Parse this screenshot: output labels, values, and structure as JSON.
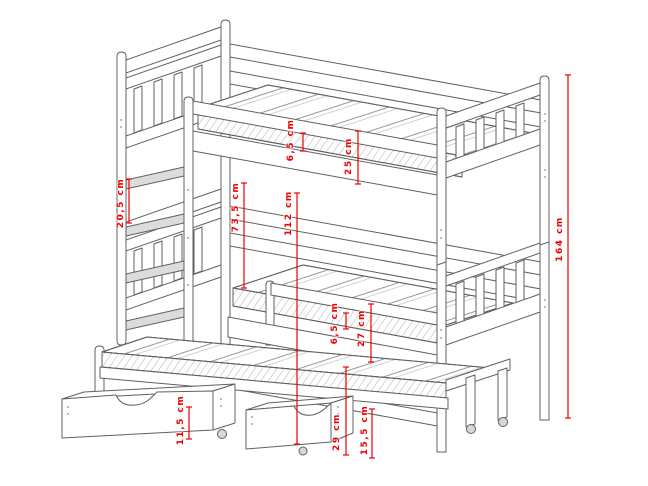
{
  "colors": {
    "dimension_red": "#f10000",
    "line_gray": "#606060",
    "background": "#ffffff"
  },
  "dimensions": [
    {
      "name": "top-mattress-thickness",
      "label": "6,5 cm"
    },
    {
      "name": "top-guardrail-height",
      "label": "25 cm"
    },
    {
      "name": "ladder-rung-spacing",
      "label": "20,5 cm"
    },
    {
      "name": "bunk-clearance-height",
      "label": "73,5 cm"
    },
    {
      "name": "top-bunk-platform-height",
      "label": "112 cm"
    },
    {
      "name": "total-bed-height",
      "label": "164 cm"
    },
    {
      "name": "bottom-mattress-thickness",
      "label": "6,5 cm"
    },
    {
      "name": "bottom-guardrail-height",
      "label": "27 cm"
    },
    {
      "name": "trundle-bed-height",
      "label": "29 cm"
    },
    {
      "name": "trundle-frame-height",
      "label": "15,5 cm"
    },
    {
      "name": "drawer-height",
      "label": "11,5 cm"
    }
  ]
}
